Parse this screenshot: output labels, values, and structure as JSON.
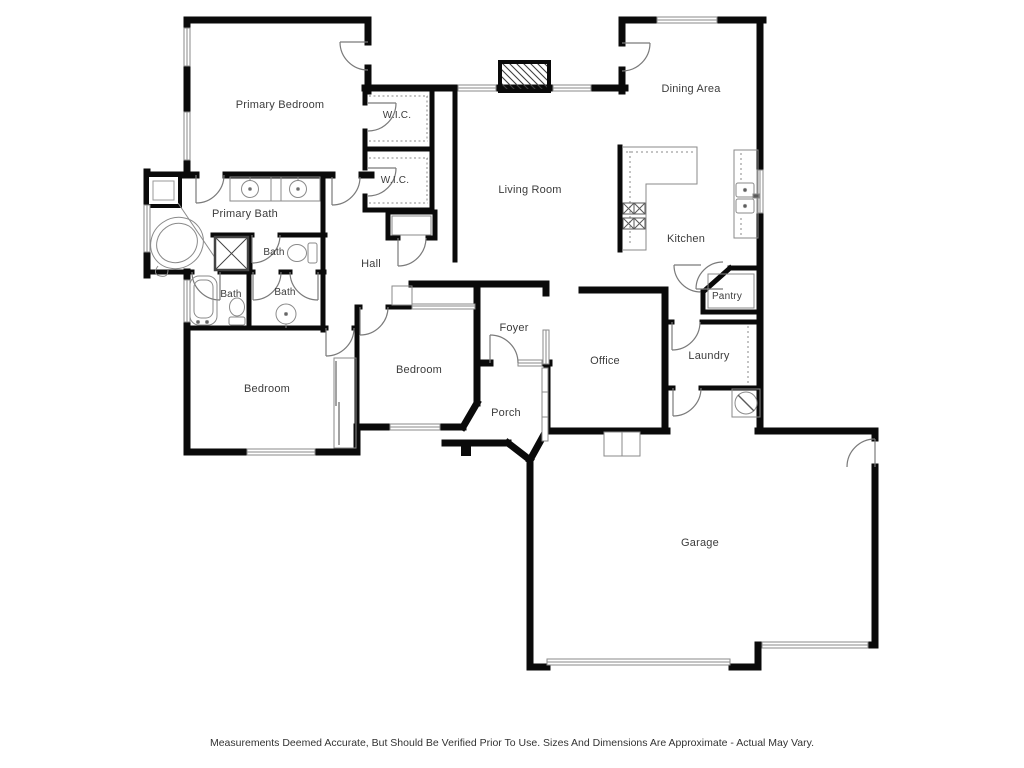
{
  "plan": {
    "colors": {
      "wall": "#0a0a0a",
      "thin_line": "#8a8a8a",
      "door_line": "#7a7a7a",
      "text": "#3c3c3c",
      "background": "#ffffff"
    },
    "rooms": {
      "primary_bedroom": "Primary Bedroom",
      "wic_upper": "W.I.C.",
      "wic_lower": "W.I.C.",
      "dining_area": "Dining Area",
      "living_room": "Living Room",
      "kitchen": "Kitchen",
      "primary_bath": "Primary Bath",
      "bath_water_closet": "Bath",
      "hall": "Hall",
      "bath_tub": "Bath",
      "bath_sink": "Bath",
      "pantry": "Pantry",
      "office": "Office",
      "laundry": "Laundry",
      "foyer": "Foyer",
      "bedroom_middle": "Bedroom",
      "bedroom_left": "Bedroom",
      "porch": "Porch",
      "garage": "Garage"
    },
    "disclaimer": "Measurements Deemed Accurate, But Should Be Verified Prior To Use. Sizes And Dimensions Are Approximate - Actual May Vary."
  }
}
